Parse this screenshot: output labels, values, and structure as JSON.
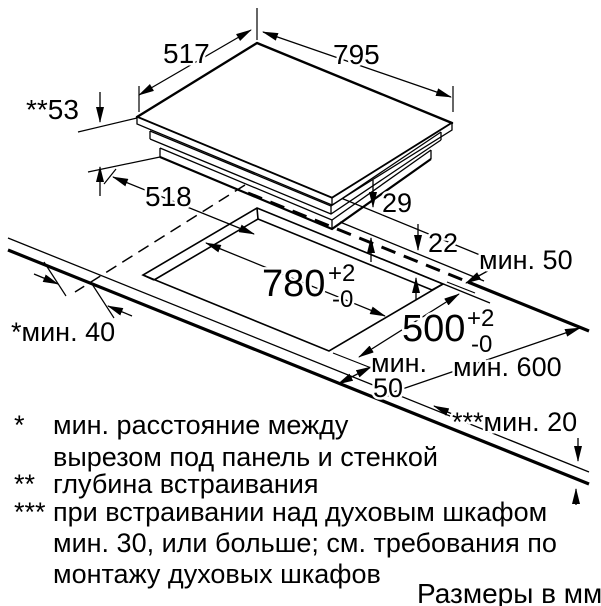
{
  "title": "Схема встраивания варочной панели",
  "units_note": "Размеры в мм",
  "labels": {
    "panel_depth": "517",
    "panel_width": "795",
    "build_in_depth": "**53",
    "offset_518": "518",
    "height_29": "29",
    "height_22": "22",
    "cutout_width": "780",
    "cutout_width_tol_plus": "+2",
    "cutout_width_tol_minus": "-0",
    "cutout_depth": "500",
    "cutout_depth_tol_plus": "+2",
    "cutout_depth_tol_minus": "-0",
    "min_back": "мин. 50",
    "worktop_depth": "мин. 600",
    "min_front_line1": "мин.",
    "min_front_line2": "50",
    "min_side": "*мин. 40",
    "min_below": "***мин. 20"
  },
  "footnotes": [
    {
      "marker": "*",
      "lines": [
        "мин. расстояние между",
        "вырезом под панель и стенкой"
      ]
    },
    {
      "marker": "**",
      "lines": [
        "глубина встраивания"
      ]
    },
    {
      "marker": "***",
      "lines": [
        "при встраивании над духовым шкафом",
        "мин. 30, или больше; см. требования по",
        "монтажу духовых шкафов"
      ]
    }
  ]
}
